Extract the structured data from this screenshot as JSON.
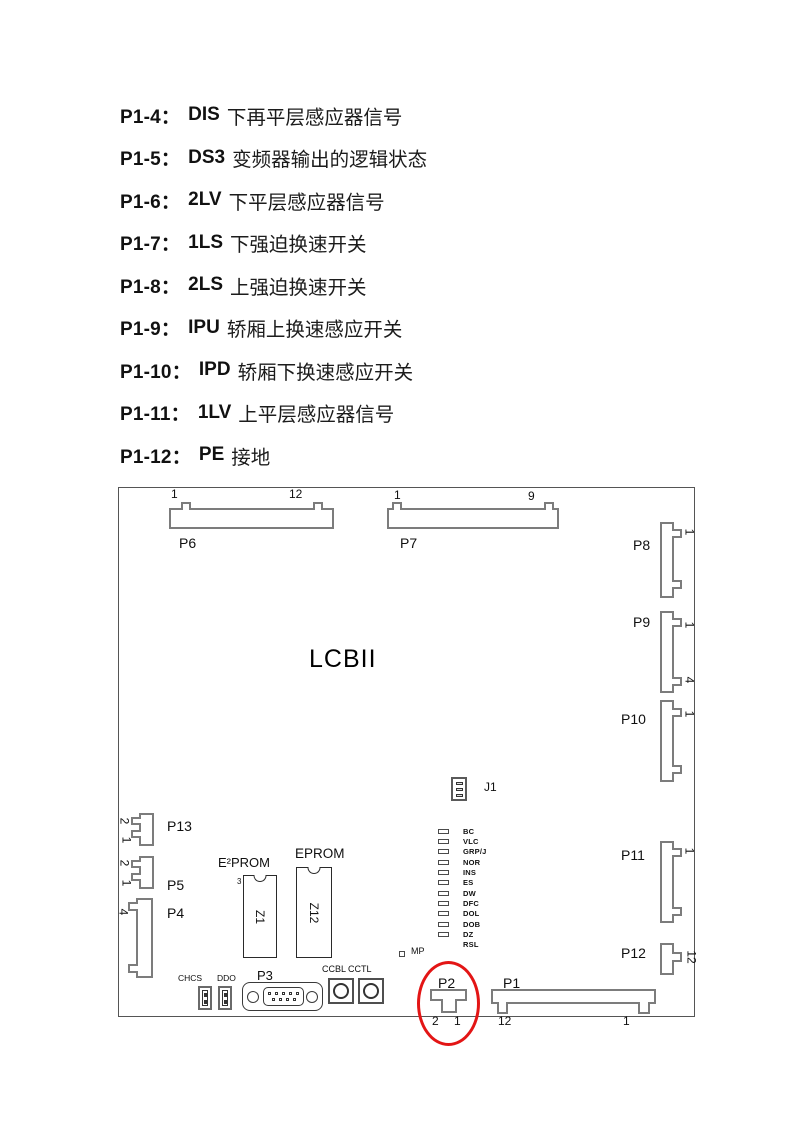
{
  "pin_list": [
    {
      "id": "P1-4：",
      "term": "DIS",
      "desc": "下再平层感应器信号"
    },
    {
      "id": "P1-5：",
      "term": "DS3",
      "desc": "变频器输出的逻辑状态"
    },
    {
      "id": "P1-6：",
      "term": "2LV",
      "desc": "下平层感应器信号"
    },
    {
      "id": "P1-7：",
      "term": "1LS",
      "desc": "下强迫换速开关"
    },
    {
      "id": "P1-8：",
      "term": "2LS",
      "desc": "上强迫换速开关"
    },
    {
      "id": "P1-9：",
      "term": "IPU",
      "desc": "轿厢上换速感应开关"
    },
    {
      "id": "P1-10：",
      "term": "IPD",
      "desc": "轿厢下换速感应开关"
    },
    {
      "id": "P1-11：",
      "term": "1LV",
      "desc": "上平层感应器信号"
    },
    {
      "id": "P1-12：",
      "term": "PE",
      "desc": "接地"
    }
  ],
  "board": {
    "title": "LCBII",
    "highlight_color": "#e31515",
    "connectors": {
      "p6": {
        "label": "P6",
        "pin_first": "1",
        "pin_last": "12"
      },
      "p7": {
        "label": "P7",
        "pin_first": "1",
        "pin_last": "9"
      },
      "p8": {
        "label": "P8",
        "pin_top": "1"
      },
      "p9": {
        "label": "P9",
        "pin_top": "1",
        "pin_bottom": "4"
      },
      "p10": {
        "label": "P10",
        "pin_top": "1"
      },
      "p11": {
        "label": "P11",
        "pin_top": "1"
      },
      "p12": {
        "label": "P12",
        "pin_side": "12"
      },
      "p13": {
        "label": "P13",
        "pin_top": "2",
        "pin_bottom": "1"
      },
      "p5": {
        "label": "P5",
        "pin_top": "2",
        "pin_bottom": "1"
      },
      "p4": {
        "label": "P4",
        "pin_top": "4"
      },
      "p3": {
        "label": "P3"
      },
      "p2": {
        "label": "P2",
        "pin_left": "2",
        "pin_right": "1"
      },
      "p1": {
        "label": "P1",
        "pin_left": "12",
        "pin_right": "1"
      }
    },
    "chips": {
      "eeprom": {
        "title": "E²PROM",
        "name": "Z1",
        "pin": "3"
      },
      "eprom": {
        "title": "EPROM",
        "name": "Z12"
      }
    },
    "jumper": {
      "label": "J1"
    },
    "leds": [
      "BC",
      "VLC",
      "GRP/J",
      "NOR",
      "INS",
      "ES",
      "DW",
      "DFC",
      "DOL",
      "DOB",
      "DZ",
      "RSL"
    ],
    "mp": {
      "label": "MP"
    },
    "switches": {
      "chcs": "CHCS",
      "ddo": "DDO"
    },
    "pots": {
      "ccbl": "CCBL",
      "cctl": "CCTL"
    }
  }
}
